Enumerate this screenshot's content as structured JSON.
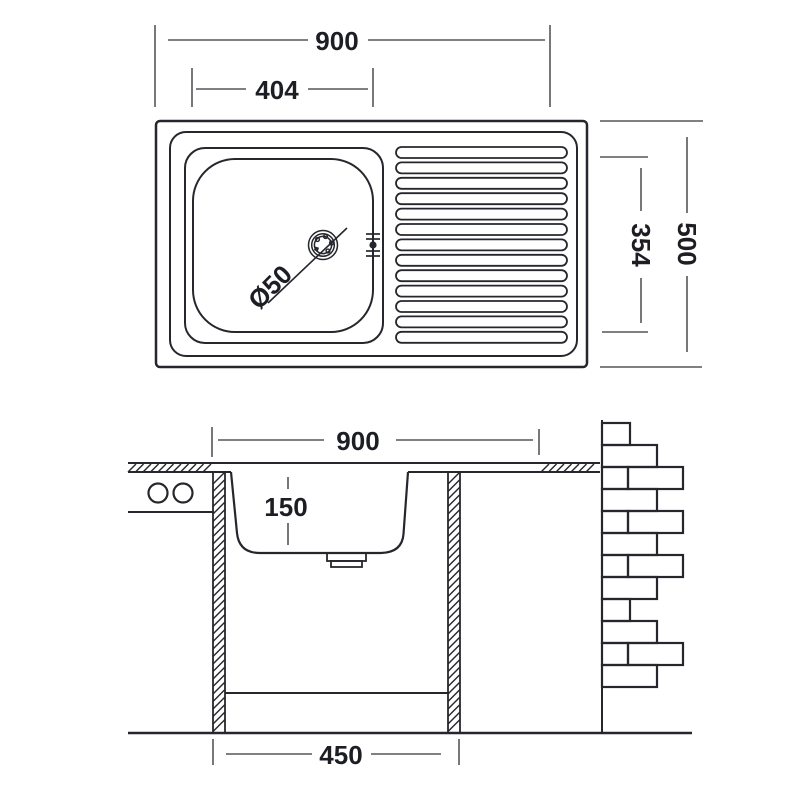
{
  "drawing": {
    "background": "#ffffff",
    "line_color": "#26272c",
    "dim_color": "#55565c",
    "text_color": "#1d1e23",
    "views": {
      "top": {
        "name": "sink top view",
        "dims": {
          "overall_width": "900",
          "bowl_width": "404",
          "overall_depth": "500",
          "bowl_depth": "354",
          "drain_diameter": "Ø50"
        },
        "rib_count": 13
      },
      "front": {
        "name": "sink front section view",
        "dims": {
          "overall_width": "900",
          "bowl_height": "150",
          "cabinet_width": "450"
        }
      }
    },
    "brick_rows": [
      [
        28
      ],
      [
        55
      ],
      [
        26,
        55
      ],
      [
        55
      ],
      [
        26,
        55
      ],
      [
        55
      ],
      [
        26,
        55
      ],
      [
        55
      ],
      [
        28
      ],
      [
        55
      ],
      [
        26,
        55
      ],
      [
        55
      ]
    ]
  }
}
